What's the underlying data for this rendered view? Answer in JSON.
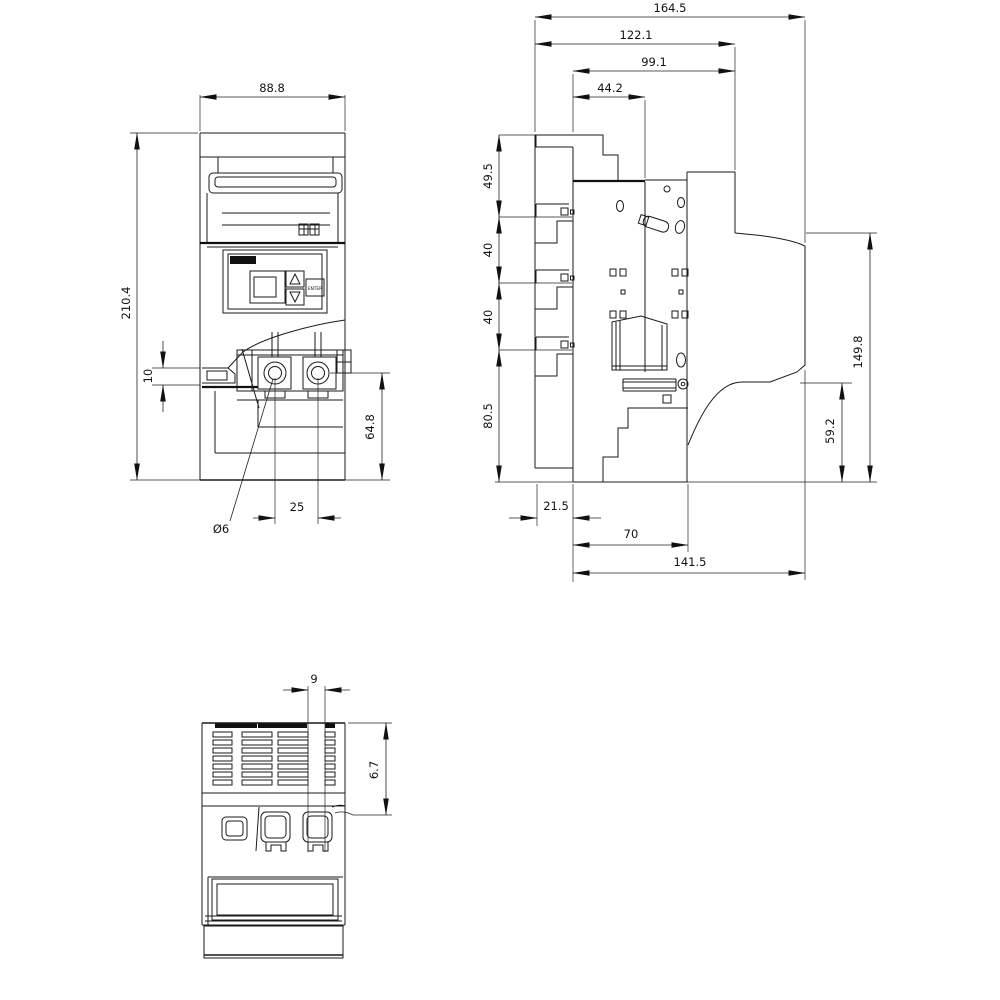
{
  "front_view": {
    "dim_width": "88.8",
    "dim_height": "210.4",
    "dim_terminal_offset": "10",
    "dim_base_height": "64.8",
    "dim_terminal_pitch": "25",
    "dim_hole_diameter": "Ø6",
    "enter_button": "ENTER"
  },
  "side_view": {
    "dim_overall_depth": "164.5",
    "dim_depth_122": "122.1",
    "dim_depth_99": "99.1",
    "dim_depth_44": "44.2",
    "dim_top_section": "49.5",
    "dim_pitch_upper": "40",
    "dim_pitch_lower": "40",
    "dim_lower_section": "80.5",
    "dim_front_height": "149.8",
    "dim_ledge_height": "59.2",
    "dim_rail_offset": "21.5",
    "dim_base_70": "70",
    "dim_base_overall": "141.5"
  },
  "bottom_view": {
    "dim_slot_gap": "9",
    "dim_vent_depth": "6.7"
  }
}
